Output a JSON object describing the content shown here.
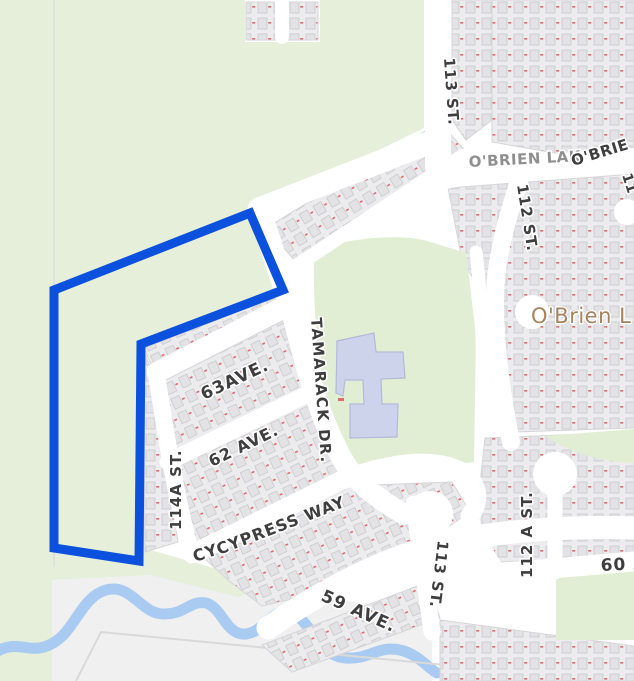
{
  "map": {
    "labels": [
      {
        "name": "113-st-north",
        "text": "113 ST."
      },
      {
        "name": "obrien-lak",
        "text": "O'BRIEN LAK"
      },
      {
        "name": "obrie-partial",
        "text": "O'BRIE"
      },
      {
        "name": "11-partial",
        "text": "11"
      },
      {
        "name": "112-st",
        "text": "112 ST."
      },
      {
        "name": "obrien-lake-name",
        "text": "O'Brien L"
      },
      {
        "name": "63-ave",
        "text": "63AVE."
      },
      {
        "name": "tamarack-dr",
        "text": "TAMARACK DR."
      },
      {
        "name": "62-ave",
        "text": "62 AVE."
      },
      {
        "name": "114a-st",
        "text": "114A ST."
      },
      {
        "name": "cy-partial",
        "text": "CY"
      },
      {
        "name": "cypress-way",
        "text": "CYPRESS WAY"
      },
      {
        "name": "59-ave",
        "text": "59 AVE."
      },
      {
        "name": "113-st-south",
        "text": "113 ST."
      },
      {
        "name": "112-a-st",
        "text": "112 A ST."
      },
      {
        "name": "60-ave",
        "text": "60 AVE."
      }
    ],
    "highlight": {
      "description": "selected-parcel-outline",
      "points": "250,213 283,290 141,344 139,561 54,548 54,290",
      "color": "#0b51dd",
      "stroke_width": 9
    },
    "colors": {
      "highlight": "#0b51dd",
      "field_green": "#e5efda",
      "park_green": "#e2eed3",
      "water": "#a9cbf1",
      "building": "#ccd3ea",
      "building_border": "#b3bad9",
      "road": "#ffffff",
      "gray_land": "#f0f0f1",
      "block_fill": "#ececee",
      "block_border": "#d6d6d8",
      "house_fill": "#e3e3e6",
      "house_border": "#c9c9cd",
      "house_number_red": "#e0696c",
      "label": "#3e3e3e",
      "label_gray": "#8f8f8f",
      "label_halo": "#ffffff",
      "place_label": "#a5835f",
      "parcel_line": "#dddddd",
      "field_outline": "#d9d9d9"
    }
  }
}
